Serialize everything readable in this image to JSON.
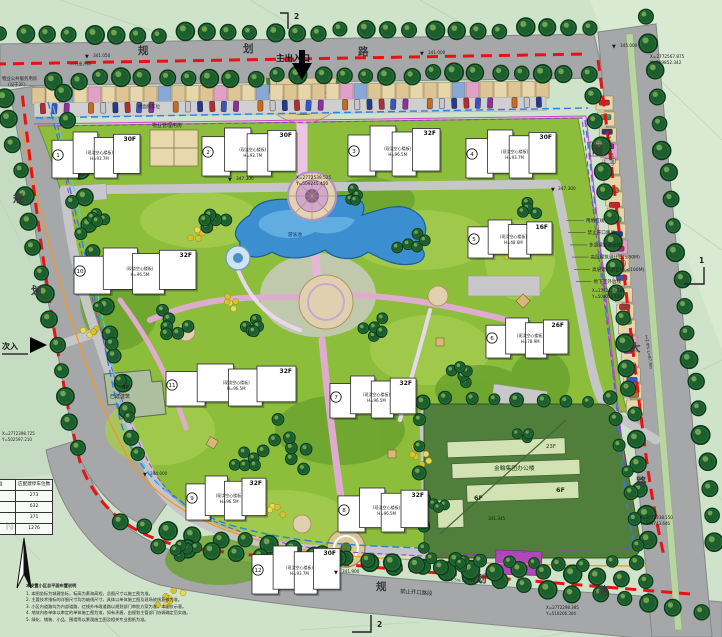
{
  "plan": {
    "main_entrance": "主出入口",
    "secondary_entrance": "次入",
    "pedestrian_entrance": "人行出入口",
    "north_label": "N",
    "pool_label": "游泳池"
  },
  "roads": {
    "top": [
      "规",
      "划",
      "路"
    ],
    "left": [
      "规",
      "划"
    ],
    "right": [
      "闽",
      "大",
      "路"
    ],
    "bottom": [
      "规",
      "划",
      "路"
    ]
  },
  "boundary_labels": [
    "用地红线",
    "禁止开口路段",
    "多层建筑退让线",
    "高层建筑退让线(≤80M)",
    "高层建筑退让线(≤100M)",
    "地下室外边线"
  ],
  "section_marks": {
    "top": "2",
    "right": "1",
    "bottom": "2"
  },
  "buildings": [
    {
      "no": "1",
      "floors": "30F",
      "note": "(现浇空心楼板)",
      "height": "H=93.7M"
    },
    {
      "no": "2",
      "floors": "30F",
      "note": "(现浇空心楼板)",
      "height": "H=93.7M"
    },
    {
      "no": "3",
      "floors": "32F",
      "note": "(现浇空心楼板)",
      "height": "H=96.5M"
    },
    {
      "no": "4",
      "floors": "30F",
      "note": "(现浇空心楼板)",
      "height": "H=93.7M"
    },
    {
      "no": "5",
      "floors": "16F",
      "note": "(现浇空心楼板)",
      "height": "H=48.6M"
    },
    {
      "no": "6",
      "floors": "26F",
      "note": "(现浇空心楼板)",
      "height": "H=78.9M"
    },
    {
      "no": "7",
      "floors": "32F",
      "note": "(现浇空心楼板)",
      "height": "H=96.5M"
    },
    {
      "no": "8",
      "floors": "32F",
      "note": "(现浇空心楼板)",
      "height": "H=96.5M"
    },
    {
      "no": "9",
      "floors": "32F",
      "note": "(现浇空心楼板)",
      "height": "H=96.5M"
    },
    {
      "no": "10",
      "floors": "32F",
      "note": "(现浇空心楼板)",
      "height": "H=96.5M"
    },
    {
      "no": "11",
      "floors": "32F",
      "note": "(现浇空心楼板)",
      "height": "H=96.5M"
    },
    {
      "no": "12",
      "floors": "30F",
      "note": "(现浇空心楼板)",
      "height": "H=93.7M"
    }
  ],
  "facilities": {
    "property_mgmt": "物业管理用房",
    "property_service_1": "物业公共服务用房",
    "property_service_2": "(设于2F)",
    "existing_floors": "4F",
    "existing": "已建建筑",
    "office_name": "金輪集团办公楼",
    "office_tower": "23F",
    "office_f1": "6F",
    "office_f2": "6F",
    "parking_strip": "地面停车位",
    "no_open_bottom": "禁止开口路段"
  },
  "parking_table": {
    "headers": [
      "标准",
      "应配建停车位数"
    ],
    "rows": [
      "273",
      "632",
      "371",
      "1276"
    ]
  },
  "notes": {
    "title": "本安置小区总平面布置说明",
    "items": [
      "本图坐标为城建坐标，标高为黄海高程，总图尺寸以施工图为准。",
      "主要技术指标的详细尺寸均为轴线尺寸，具体以单体施工图及现场放线复核为准。",
      "小区内道路均为内部道路，红线外市政道路以规划部门审批方案为准，本图仅示意。",
      "地块内各单体以审定的单体施工图为准，如有矛盾，由规划主管部门协调确定后实施。",
      "绿化、铺装、小品、围墙等以景观施工图及相关专业图纸为准。"
    ]
  },
  "annotations": [
    {
      "t": "▼",
      "x": 85,
      "y": 58,
      "s": 5
    },
    {
      "t": "341.050",
      "x": 93,
      "y": 57,
      "s": 4.2
    },
    {
      "t": "人行出入口",
      "x": 70,
      "y": 65,
      "s": 4.2
    },
    {
      "t": "▼",
      "x": 420,
      "y": 55,
      "s": 5
    },
    {
      "t": "341.000",
      "x": 428,
      "y": 54,
      "s": 4.2
    },
    {
      "t": "▼",
      "x": 612,
      "y": 48,
      "s": 5
    },
    {
      "t": "345.000",
      "x": 620,
      "y": 47,
      "s": 4.2
    },
    {
      "t": "X=2772567.875",
      "x": 650,
      "y": 58,
      "s": 4.2
    },
    {
      "t": "Y=509852.342",
      "x": 650,
      "y": 64,
      "s": 4.2
    },
    {
      "t": "i=2.0% L=85.9m",
      "x": 607,
      "y": 132,
      "s": 4,
      "rot": 82
    },
    {
      "t": "X=2772539.525",
      "x": 296,
      "y": 179,
      "s": 4.3
    },
    {
      "t": "Y=509245.450",
      "x": 296,
      "y": 185,
      "s": 4.3
    },
    {
      "t": "▼",
      "x": 228,
      "y": 181,
      "s": 5
    },
    {
      "t": "347.300",
      "x": 236,
      "y": 180,
      "s": 4.3
    },
    {
      "t": "▼",
      "x": 551,
      "y": 191,
      "s": 5
    },
    {
      "t": "347.300",
      "x": 558,
      "y": 190,
      "s": 4.3
    },
    {
      "t": "X=2772454.186",
      "x": 592,
      "y": 292,
      "s": 4
    },
    {
      "t": "Y=509054.130",
      "x": 592,
      "y": 298,
      "s": 4
    },
    {
      "t": "i=2.9% L=87.9m",
      "x": 645,
      "y": 335,
      "s": 4,
      "rot": 82
    },
    {
      "t": "X=2772398.725",
      "x": 2,
      "y": 435,
      "s": 4
    },
    {
      "t": "Y=502597.210",
      "x": 2,
      "y": 441,
      "s": 4
    },
    {
      "t": "▼",
      "x": 143,
      "y": 476,
      "s": 5
    },
    {
      "t": "344.000",
      "x": 150,
      "y": 475,
      "s": 4.2
    },
    {
      "t": "X=2772238.150",
      "x": 640,
      "y": 519,
      "s": 4
    },
    {
      "t": "Y=509743.646",
      "x": 640,
      "y": 525,
      "s": 4
    },
    {
      "t": "▼",
      "x": 334,
      "y": 574,
      "s": 5
    },
    {
      "t": "341.900",
      "x": 342,
      "y": 573,
      "s": 4.2
    },
    {
      "t": "i=1.5% L=116.3m",
      "x": 446,
      "y": 581,
      "s": 4,
      "rot": 3
    },
    {
      "t": "X=2772298.385",
      "x": 546,
      "y": 609,
      "s": 4
    },
    {
      "t": "Y=510206.304",
      "x": 546,
      "y": 615,
      "s": 4
    },
    {
      "t": "341.345",
      "x": 488,
      "y": 520,
      "s": 4.2
    }
  ],
  "colors": {
    "red_line": "#e81212",
    "blue_line": "#2b7fe8",
    "purple_line": "#9a3cc8",
    "orange_line": "#f59622",
    "water": "#3b8fd0",
    "lawn": "#8cbe3c"
  }
}
